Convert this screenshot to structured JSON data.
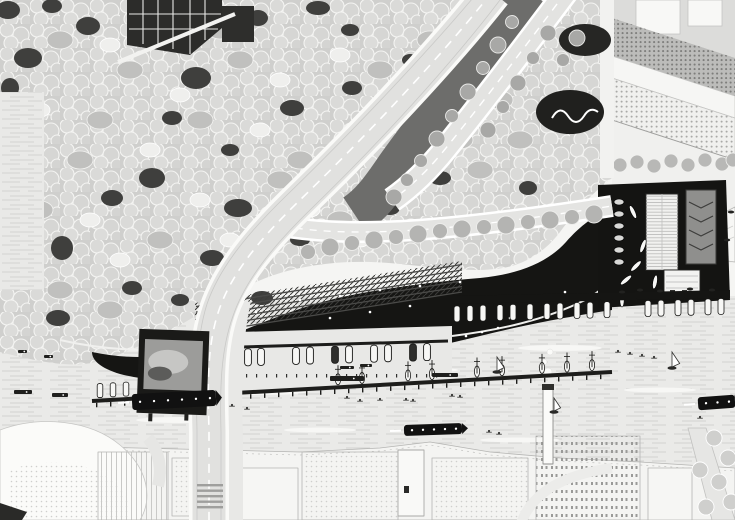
{
  "meta": {
    "title": "waterfront-district-aerial-illustration",
    "canvas_w": 735,
    "canvas_h": 520
  },
  "palette": {
    "paper": "#f5f5f3",
    "water": "#eaeae8",
    "water_line": "#d0d0ce",
    "canopy_base": "#cfcfcd",
    "canopy_blob": "#dadad8",
    "canopy_light": "#efefed",
    "canopy_mid": "#c0c0be",
    "canopy_dark": "#3f3f3d",
    "road_fill": "#e2e2e0",
    "road_edge": "#ffffff",
    "road_line": "#c7c7c5",
    "corridor": "#6d6d6b",
    "ink": "#151513",
    "step_line": "#4a4a48",
    "city_fill": "#f4f4f2",
    "city_line": "#b5b5b3",
    "campus_dot": "#7e7e7c",
    "boat_white": "#f7f7f5",
    "boat_stroke": "#1a1a18",
    "people": "#ffffff",
    "gray_building": "#8f8f8d",
    "billboard_photo": "#9c9c9a"
  },
  "scene": {
    "canopy": {
      "dark_patches": [
        [
          28,
          58,
          14,
          10
        ],
        [
          88,
          26,
          12,
          9
        ],
        [
          196,
          78,
          15,
          11
        ],
        [
          258,
          18,
          10,
          8
        ],
        [
          318,
          8,
          12,
          7
        ],
        [
          152,
          178,
          13,
          10
        ],
        [
          62,
          248,
          11,
          12
        ],
        [
          238,
          208,
          14,
          9
        ],
        [
          332,
          178,
          12,
          8
        ],
        [
          422,
          118,
          13,
          9
        ],
        [
          468,
          58,
          11,
          8
        ],
        [
          390,
          208,
          10,
          7
        ],
        [
          292,
          108,
          12,
          8
        ],
        [
          172,
          118,
          10,
          7
        ],
        [
          112,
          198,
          11,
          8
        ],
        [
          212,
          258,
          12,
          8
        ],
        [
          352,
          88,
          10,
          7
        ],
        [
          440,
          178,
          11,
          7
        ],
        [
          30,
          138,
          10,
          12
        ],
        [
          58,
          318,
          12,
          8
        ],
        [
          132,
          288,
          10,
          7
        ],
        [
          262,
          298,
          11,
          7
        ],
        [
          478,
          228,
          10,
          7
        ],
        [
          528,
          188,
          9,
          7
        ],
        [
          10,
          88,
          9,
          10
        ],
        [
          350,
          30,
          9,
          6
        ],
        [
          410,
          60,
          8,
          6
        ],
        [
          230,
          150,
          9,
          6
        ],
        [
          300,
          240,
          10,
          6
        ],
        [
          180,
          300,
          9,
          6
        ],
        [
          8,
          10,
          12,
          9
        ],
        [
          52,
          6,
          10,
          7
        ]
      ],
      "mid_patches": [
        [
          60,
          40
        ],
        [
          130,
          70
        ],
        [
          240,
          60
        ],
        [
          300,
          160
        ],
        [
          360,
          130
        ],
        [
          430,
          40
        ],
        [
          200,
          120
        ],
        [
          80,
          160
        ],
        [
          40,
          210
        ],
        [
          160,
          240
        ],
        [
          280,
          180
        ],
        [
          380,
          70
        ],
        [
          460,
          140
        ],
        [
          500,
          100
        ],
        [
          340,
          220
        ],
        [
          100,
          120
        ],
        [
          20,
          180
        ],
        [
          140,
          20
        ],
        [
          220,
          30
        ],
        [
          480,
          170
        ],
        [
          520,
          140
        ],
        [
          60,
          290
        ],
        [
          110,
          310
        ],
        [
          250,
          250
        ]
      ],
      "light_patches": [
        [
          110,
          45
        ],
        [
          180,
          95
        ],
        [
          260,
          130
        ],
        [
          340,
          55
        ],
        [
          410,
          150
        ],
        [
          90,
          220
        ],
        [
          150,
          150
        ],
        [
          230,
          240
        ],
        [
          310,
          210
        ],
        [
          390,
          180
        ],
        [
          470,
          100
        ],
        [
          40,
          110
        ],
        [
          200,
          200
        ],
        [
          280,
          80
        ],
        [
          360,
          240
        ],
        [
          120,
          260
        ],
        [
          500,
          60
        ],
        [
          430,
          230
        ]
      ]
    },
    "corridor_trees": [
      [
        512,
        22
      ],
      [
        498,
        45
      ],
      [
        483,
        68
      ],
      [
        468,
        92
      ],
      [
        452,
        116
      ],
      [
        437,
        139
      ],
      [
        421,
        161
      ],
      [
        548,
        33
      ],
      [
        533,
        58
      ],
      [
        518,
        83
      ],
      [
        503,
        107
      ],
      [
        488,
        130
      ],
      [
        407,
        180
      ],
      [
        394,
        197
      ],
      [
        563,
        60
      ],
      [
        577,
        38
      ]
    ],
    "south_trees": [
      [
        308,
        252
      ],
      [
        330,
        247
      ],
      [
        352,
        243
      ],
      [
        374,
        240
      ],
      [
        396,
        237
      ],
      [
        418,
        234
      ],
      [
        440,
        231
      ],
      [
        462,
        229
      ],
      [
        484,
        227
      ],
      [
        506,
        225
      ],
      [
        528,
        222
      ],
      [
        550,
        220
      ],
      [
        572,
        217
      ],
      [
        594,
        214
      ]
    ],
    "campus_trees": [
      [
        620,
        165
      ],
      [
        637,
        162
      ],
      [
        654,
        166
      ],
      [
        671,
        161
      ],
      [
        688,
        165
      ],
      [
        705,
        160
      ],
      [
        722,
        164
      ],
      [
        733,
        160
      ]
    ],
    "corner_trees": [
      [
        714,
        438
      ],
      [
        728,
        458
      ],
      [
        719,
        482
      ],
      [
        731,
        502
      ],
      [
        706,
        507
      ],
      [
        700,
        470
      ]
    ],
    "promenade_people": [
      [
        165,
        335
      ],
      [
        180,
        342
      ],
      [
        196,
        338
      ],
      [
        210,
        346
      ],
      [
        224,
        340
      ],
      [
        238,
        349
      ],
      [
        252,
        343
      ],
      [
        266,
        352
      ],
      [
        280,
        346
      ],
      [
        295,
        354
      ],
      [
        310,
        348
      ],
      [
        325,
        355
      ],
      [
        340,
        350
      ],
      [
        356,
        357
      ],
      [
        372,
        352
      ],
      [
        388,
        358
      ],
      [
        402,
        353
      ],
      [
        418,
        348
      ],
      [
        434,
        344
      ],
      [
        450,
        340
      ],
      [
        466,
        336
      ],
      [
        482,
        332
      ],
      [
        498,
        328
      ],
      [
        256,
        312
      ],
      [
        300,
        300
      ],
      [
        340,
        296
      ],
      [
        380,
        290
      ],
      [
        420,
        286
      ],
      [
        460,
        282
      ],
      [
        510,
        318
      ],
      [
        530,
        310
      ],
      [
        548,
        300
      ],
      [
        565,
        292
      ],
      [
        330,
        318
      ],
      [
        370,
        312
      ],
      [
        410,
        306
      ]
    ],
    "dock_people": {
      "x_from": 186,
      "x_to": 444,
      "step": 10,
      "y": 374
    },
    "steps": {
      "count": 6,
      "x1": 196,
      "y1": 334,
      "x2": 462,
      "y2": 292,
      "dy": 5.5
    },
    "piers": {
      "p1": {
        "x1": 452,
        "x2": 730,
        "y": 300,
        "boats_y": 306,
        "boat_xs": [
          457,
          470,
          483,
          500,
          513,
          530,
          547,
          560,
          577,
          590,
          607,
          648,
          661,
          678,
          691,
          708,
          721
        ],
        "small": [
          [
            622,
            292
          ],
          [
            640,
            290
          ],
          [
            660,
            291
          ],
          [
            690,
            289
          ],
          [
            712,
            290
          ],
          [
            731,
            212
          ],
          [
            727,
            240
          ]
        ]
      },
      "p2": {
        "x1": 92,
        "y1": 401,
        "x2": 612,
        "y2": 372,
        "post_step": 14,
        "left_boats": [
          100,
          113,
          126,
          152,
          165,
          191,
          204,
          230
        ],
        "masts": [
          338,
          362,
          408,
          432,
          477,
          502,
          542,
          567,
          592
        ]
      },
      "p3": {
        "x1": 172,
        "y1": 349,
        "x2": 448,
        "y2": 341,
        "boat_xs": [
          188,
          201,
          224,
          248,
          261,
          296,
          310,
          335,
          349,
          374,
          388,
          413,
          427
        ],
        "dark_idx": [
          2,
          7,
          11
        ]
      }
    },
    "barges": [
      [
        330,
        376,
        34,
        5
      ],
      [
        432,
        373,
        26,
        4
      ],
      [
        14,
        390,
        18,
        4
      ],
      [
        52,
        393,
        16,
        4
      ],
      [
        340,
        366,
        14,
        3
      ],
      [
        360,
        364,
        12,
        3
      ],
      [
        18,
        350,
        9,
        3
      ],
      [
        44,
        355,
        9,
        3
      ]
    ],
    "kayaks": [
      [
        347,
        397
      ],
      [
        360,
        400
      ],
      [
        380,
        399
      ],
      [
        406,
        399
      ],
      [
        413,
        400
      ],
      [
        452,
        395
      ],
      [
        460,
        396
      ],
      [
        489,
        431
      ],
      [
        499,
        433
      ],
      [
        232,
        405
      ],
      [
        247,
        408
      ],
      [
        618,
        351
      ],
      [
        630,
        353
      ],
      [
        642,
        355
      ],
      [
        654,
        357
      ],
      [
        700,
        417
      ]
    ],
    "sailboats": [
      [
        497,
        370,
        13
      ],
      [
        672,
        366,
        14
      ],
      [
        554,
        410,
        12
      ]
    ],
    "ferries": [
      [
        132,
        392,
        84,
        16,
        -3,
        6
      ],
      [
        404,
        424,
        58,
        11,
        -2,
        5
      ],
      [
        698,
        396,
        37,
        13,
        -4,
        3
      ]
    ],
    "boatyard": {
      "lifts_x": 619,
      "lifts_y": [
        202,
        214,
        226,
        238,
        250,
        262
      ],
      "boats": [
        [
          633,
          212,
          -25
        ],
        [
          643,
          246,
          20
        ],
        [
          626,
          280,
          50
        ],
        [
          636,
          266,
          45
        ],
        [
          655,
          282,
          10
        ],
        [
          622,
          300,
          0
        ]
      ]
    },
    "water_streaks": [
      [
        80,
        330,
        40,
        3
      ],
      [
        260,
        392,
        46,
        3
      ],
      [
        420,
        370,
        38,
        2.5
      ],
      [
        560,
        348,
        42,
        3
      ],
      [
        660,
        390,
        36,
        2.5
      ],
      [
        180,
        420,
        44,
        3
      ],
      [
        520,
        440,
        40,
        2.5
      ],
      [
        320,
        430,
        36,
        2.5
      ]
    ],
    "smoke": [
      [
        548,
        372,
        4
      ],
      [
        544,
        362,
        3
      ],
      [
        550,
        352,
        3
      ]
    ],
    "crossing": {
      "x": 197,
      "w": 26,
      "y0": 484,
      "step": 5.5,
      "count": 5
    }
  }
}
